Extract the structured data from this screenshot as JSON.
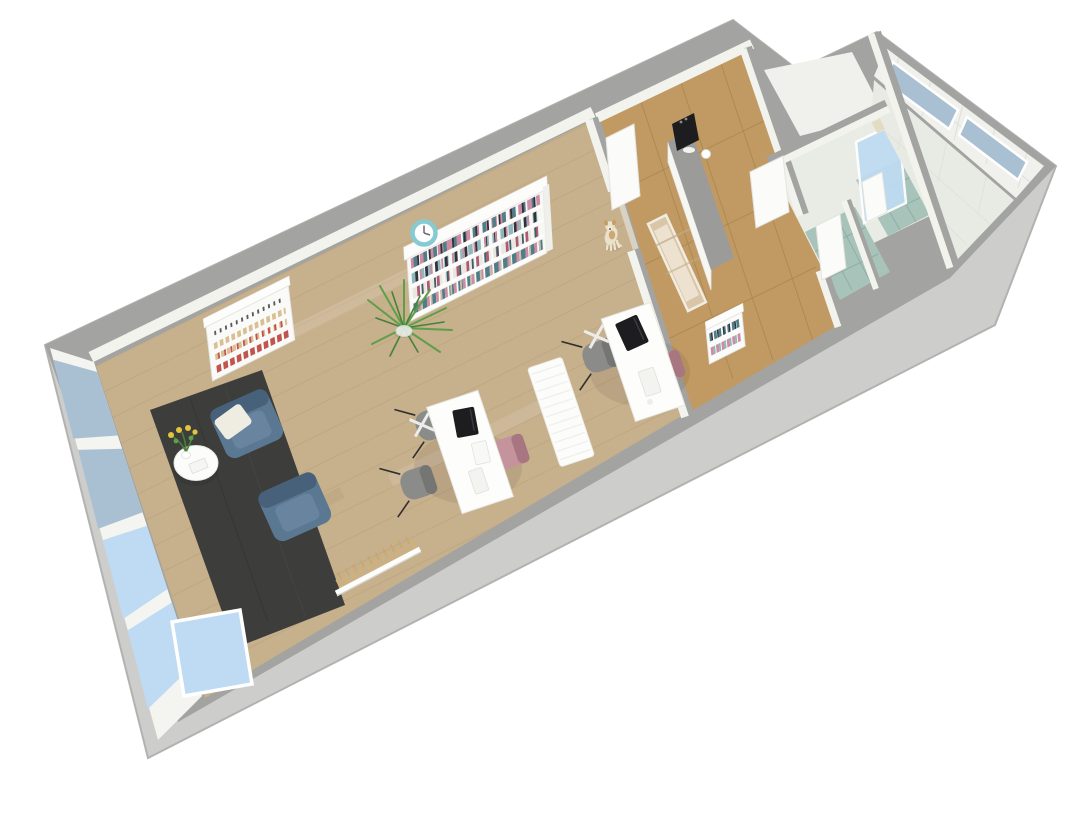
{
  "view": {
    "type": "3d-floorplan-render",
    "width": 1089,
    "height": 831,
    "description": "Isometric 3D floor plan of an elongated studio office with reception hall, two WCs and a tiled bathroom wing"
  },
  "colors": {
    "background": "#ffffff",
    "exterior_wall": "#cdcdcb",
    "wall_top": "#a3a3a1",
    "wall_face": "#f3f3ee",
    "wood_floor": "#c7b08c",
    "wood_dark": "#b89f78",
    "rug": "#3d3d3b",
    "hall_tile": "#c19a63",
    "hall_tile_line": "#ab8750",
    "bath_tile": "#a7c3ba",
    "bath_tile_line": "#8fafa5",
    "white_tile": "#f0f1ec",
    "white_tile_line": "#dddfd8",
    "glass_upper": "#a9c0d2",
    "glass_lower": "#bedbf3",
    "frame": "#ffffff",
    "desk": "#fdfdfb",
    "desk_edge": "#e6e6e2",
    "chair_gray": "#8b8b89",
    "chair_gray_dark": "#757573",
    "chair_pink": "#c4939b",
    "chair_pink_dark": "#a87680",
    "armchair": "#5b7893",
    "armchair_dark": "#47617a",
    "armchair_light": "#68849f",
    "pillow": "#efece2",
    "table": "#fcfcfa",
    "clock": "#85cbd1",
    "plant": "#5f9e4a",
    "plant_dark": "#47813a",
    "flower": "#e3c43c",
    "machine": "#1d1d1f",
    "counter_top": "#9b9b99",
    "counter_face": "#f6f6f3",
    "dog_cream": "#ece2cb",
    "dog_tan": "#c59e66",
    "canvas": "#d9c6a9",
    "canvas_light": "#efe6d6",
    "display_beige": "#d9c093",
    "display_red": "#c1554e",
    "book0": "#cf8ba2",
    "book1": "#4f7d88",
    "book2": "#32323a",
    "book3": "#e9e7e0",
    "book4": "#8fb7bd",
    "book5": "#ad5a72",
    "book6": "#c8bead",
    "book7": "#39616b"
  },
  "scene": {
    "rooms": [
      "main-studio",
      "reception-hall",
      "wc-1",
      "wc-2",
      "shower-room",
      "bathroom-wing",
      "glazed-entry-corner"
    ],
    "furniture": [
      "bookshelf-with-books",
      "wall-clock",
      "potted-fern",
      "product-display-shelf",
      "blue-armchair-1",
      "blue-armchair-2",
      "throw-pillow",
      "round-side-table",
      "flower-vase",
      "charcoal-area-rug",
      "desk-1",
      "desk-2",
      "laptop-1",
      "laptop-2",
      "keyboard",
      "pink-office-chair-1",
      "pink-office-chair-2",
      "gray-guest-chair-1",
      "gray-guest-chair-2",
      "gray-guest-chair-3",
      "treatment-bench",
      "mini-bookshelf",
      "coat-rack-with-hangers",
      "leaning-artwork-canvas",
      "reception-counter",
      "coffee-machine",
      "coffee-cup",
      "wall-cabinet",
      "dog",
      "open-glass-entry-door",
      "window-wall",
      "clerestory-windows",
      "open-door-panels"
    ]
  }
}
